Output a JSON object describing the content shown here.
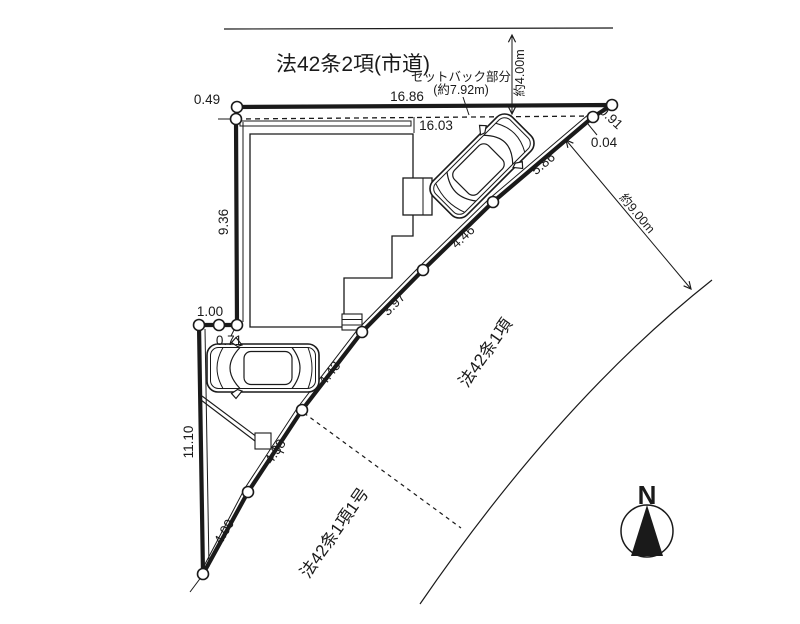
{
  "roads": {
    "top_label": "法42条2項(市道)",
    "right_label": "法42条1項",
    "bottom_label": "法42条1項1号"
  },
  "setback": {
    "caption_line1": "セットバック部分",
    "caption_line2": "(約7.92m)",
    "road_width": "約4.00m",
    "to_road": "約9.00m"
  },
  "dims": {
    "top_edge": "16.86",
    "setback_edge": "16.03",
    "offset_049": "0.49",
    "corner_091": "0.91",
    "corner_004": "0.04",
    "diag_586": "5.86",
    "diag_446": "4.46",
    "diag_397": "3.97",
    "diag_443": "4.43",
    "diag_438": "4.38",
    "diag_409": "4.09",
    "left_936": "9.36",
    "left_1110": "11.10",
    "jog_100": "1.00",
    "jog_071": "0.71"
  },
  "compass": {
    "north_label": "N"
  },
  "colors": {
    "ink": "#1a1a1a",
    "background": "#ffffff"
  }
}
